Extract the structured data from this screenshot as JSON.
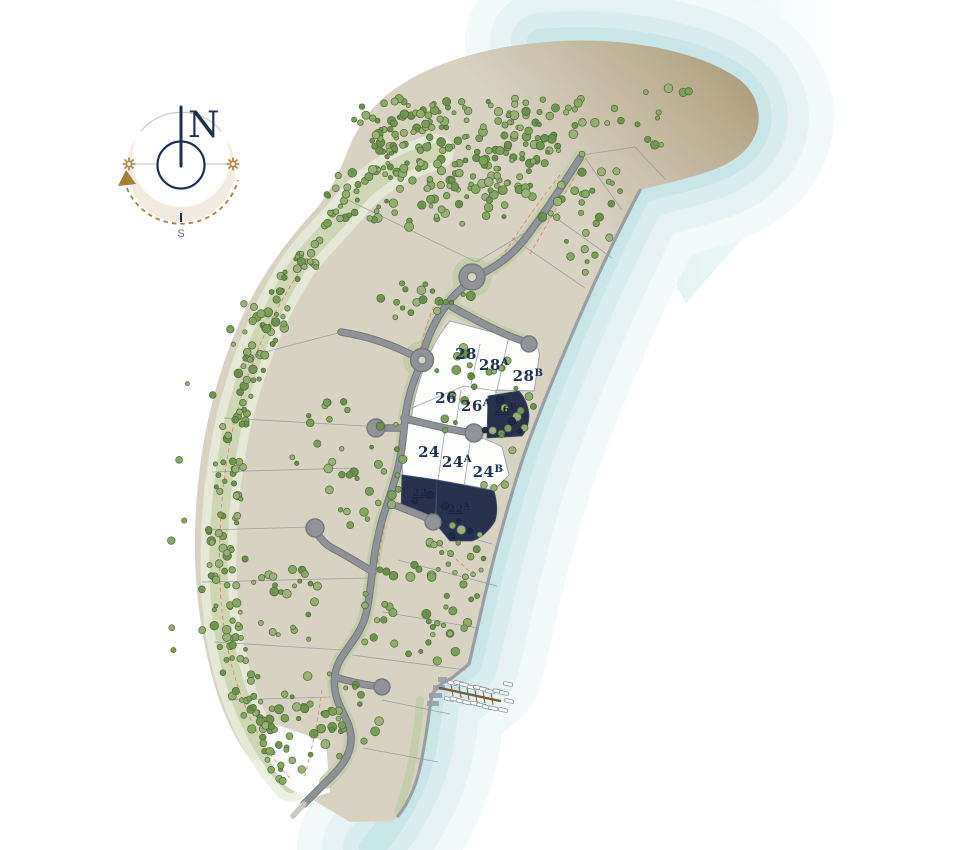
{
  "compass": {
    "north_label": "N",
    "south_label": "S"
  },
  "lots": [
    {
      "id": "28",
      "base": "28",
      "sup": "",
      "fill_style": "white"
    },
    {
      "id": "28A",
      "base": "28",
      "sup": "A",
      "fill_style": "white"
    },
    {
      "id": "28B",
      "base": "28",
      "sup": "B",
      "fill_style": "white"
    },
    {
      "id": "26",
      "base": "26",
      "sup": "",
      "fill_style": "white"
    },
    {
      "id": "26A",
      "base": "26",
      "sup": "A",
      "fill_style": "white"
    },
    {
      "id": "26B",
      "base": "26",
      "sup": "B",
      "fill_style": "navy"
    },
    {
      "id": "24",
      "base": "24",
      "sup": "",
      "fill_style": "white"
    },
    {
      "id": "24A",
      "base": "24",
      "sup": "A",
      "fill_style": "white"
    },
    {
      "id": "24B",
      "base": "24",
      "sup": "B",
      "fill_style": "white"
    },
    {
      "id": "22",
      "base": "22",
      "sup": "",
      "fill_style": "navy"
    },
    {
      "id": "22A",
      "base": "22",
      "sup": "A",
      "fill_style": "navy"
    }
  ],
  "colors": {
    "navy": "#27324f",
    "navy-dark": "#19233d",
    "label-navy": "#1d3050",
    "land": "#d8d2c1",
    "lot-white": "#fdfdfb",
    "water-1": "#c8e5e8",
    "water-2": "#d7edee",
    "water-3": "#e5f3f4",
    "water-4": "#f1f9f9",
    "road": "#8f9296",
    "road-edge": "#75787e",
    "verge": "#bfcda4",
    "band": "#ccd5b2",
    "band-halo": "#e9edda",
    "tree": "#7c9e58",
    "tree-stroke": "#4e6a36",
    "tree-navy": "#1d2946",
    "setback-red": "#e2745b",
    "parcel-line": "#8d929c",
    "seawall": "#989ea4",
    "dock-brown": "#7d5a3c",
    "compass-gold": "#a97f35",
    "cream": "#f1ebe0"
  }
}
